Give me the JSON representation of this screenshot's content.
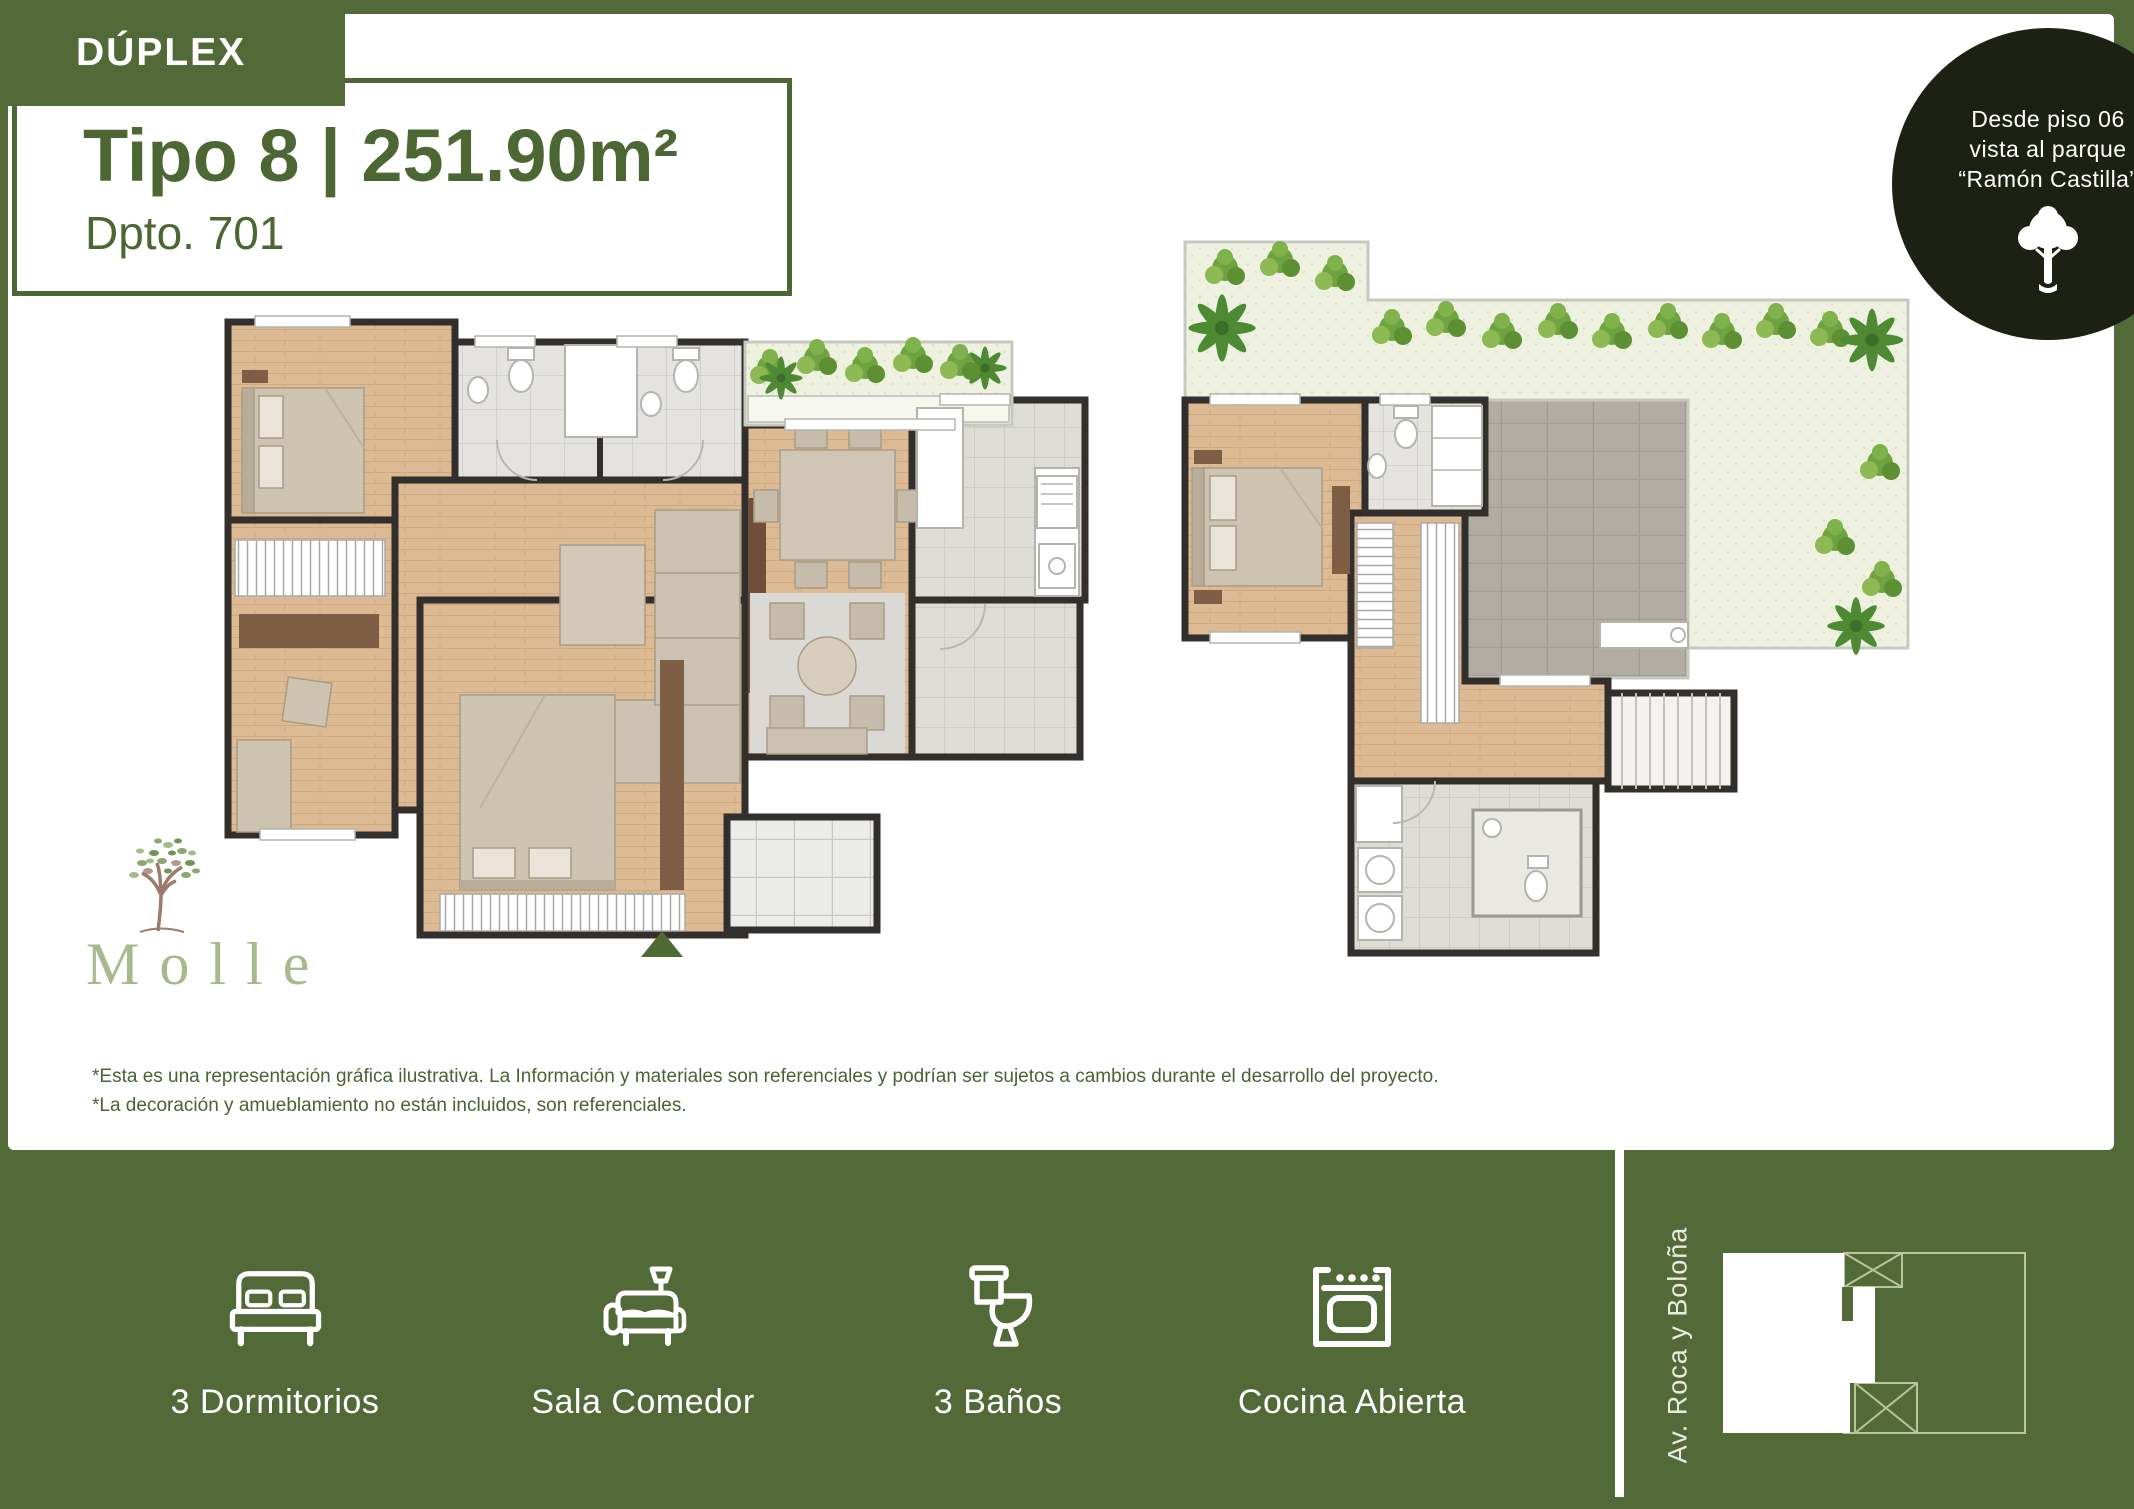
{
  "page": {
    "background_color": "#526a37",
    "panel_color": "#ffffff",
    "accent_text_color": "#4c6733"
  },
  "header": {
    "category_label": "DÚPLEX",
    "title": "Tipo 8 | 251.90m²",
    "unit": "Dpto. 701"
  },
  "badge": {
    "line1": "Desde piso 06",
    "line2": "vista al parque",
    "line3": "“Ramón Castilla”",
    "icon": "tree-icon",
    "background_color": "#1c2114"
  },
  "brand": {
    "name": "Molle",
    "icon": "tree-logo-icon",
    "color": "#a9b98e"
  },
  "disclaimer": {
    "line1": "*Esta es una representación gráfica ilustrativa. La Información y materiales son referenciales y podrían ser sujetos a cambios durante el desarrollo del proyecto.",
    "line2": "*La decoración y amueblamiento no están incluidos, son referenciales."
  },
  "amenities": [
    {
      "label": "3 Dormitorios",
      "icon": "bed-icon"
    },
    {
      "label": "Sala Comedor",
      "icon": "sofa-icon"
    },
    {
      "label": "3 Baños",
      "icon": "toilet-icon"
    },
    {
      "label": "Cocina Abierta",
      "icon": "stove-icon"
    }
  ],
  "location": {
    "street_label": "Av. Roca y Boloña",
    "map_outline_color": "#b9c59d"
  },
  "floor_plans": [
    {
      "name": "lower-level-plan"
    },
    {
      "name": "upper-level-plan"
    }
  ]
}
